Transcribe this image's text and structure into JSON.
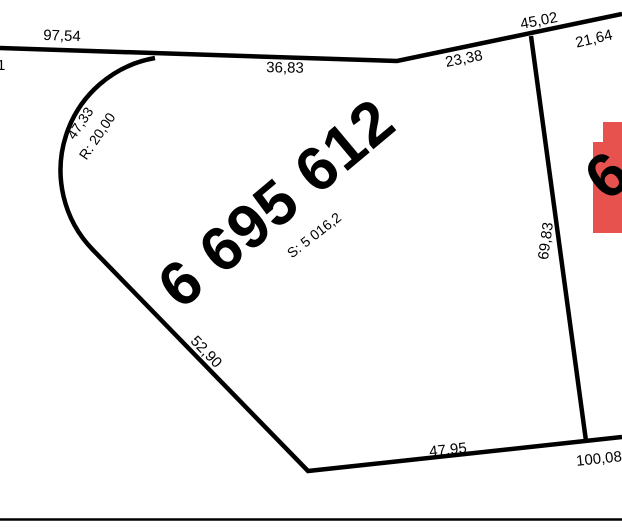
{
  "colors": {
    "line": "#000000",
    "building_fill": "#e8524e",
    "background": "#ffffff"
  },
  "parcel": {
    "number": "6 695 612",
    "area_label": "S: 5 016,2"
  },
  "adjacent_parcel": {
    "number_partial": "6"
  },
  "dimensions": {
    "top_left": "97,54",
    "left_edge_partial": "1",
    "top_middle": "36,83",
    "upper_right": "23,38",
    "top_vertex": "45,02",
    "top_right": "21,64",
    "right_side": "69,83",
    "curve_length": "47,33",
    "curve_radius": "R: 20,00",
    "left_diagonal": "52,90",
    "bottom": "47,95",
    "bottom_right": "100,08"
  }
}
